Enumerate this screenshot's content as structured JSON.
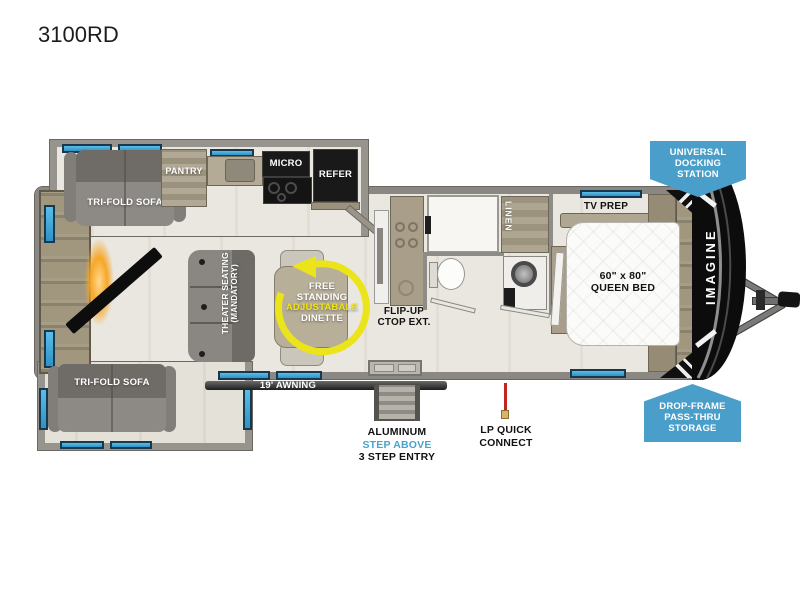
{
  "title": "3100RD",
  "brand": "IMAGINE",
  "rooms": {
    "sofa_top": "TRI-FOLD SOFA",
    "sofa_bottom": "TRI-FOLD SOFA",
    "pantry": "PANTRY",
    "micro": "MICRO",
    "refer": "REFER",
    "theater_line1": "THEATER SEATING",
    "theater_line2": "(MANDATORY)",
    "dinette_line1": "FREE",
    "dinette_line2": "STANDING",
    "dinette_line3": "ADJUSTABALE",
    "dinette_line4": "DINETTE",
    "flip_line1": "FLIP-UP",
    "flip_line2": "CTOP EXT.",
    "linen": "LINEN",
    "tv_prep": "TV PREP",
    "bed_line1": "60\" x 80\"",
    "bed_line2": "QUEEN BED"
  },
  "exterior": {
    "awning": "19' AWNING",
    "entry_line1": "ALUMINUM",
    "entry_line2": "STEP ABOVE",
    "entry_line3": "3 STEP ENTRY",
    "lp_line1": "LP QUICK",
    "lp_line2": "CONNECT"
  },
  "badges": {
    "docking_line1": "UNIVERSAL",
    "docking_line2": "DOCKING",
    "docking_line3": "STATION",
    "storage_line1": "DROP-FRAME",
    "storage_line2": "PASS-THRU",
    "storage_line3": "STORAGE"
  },
  "colors": {
    "window_blue": "#3ba4d8",
    "badge_blue": "#4a9fca",
    "accent_yellow": "#ece41a",
    "lp_red": "#c3271b",
    "step_above_blue": "#4aa3cc"
  }
}
